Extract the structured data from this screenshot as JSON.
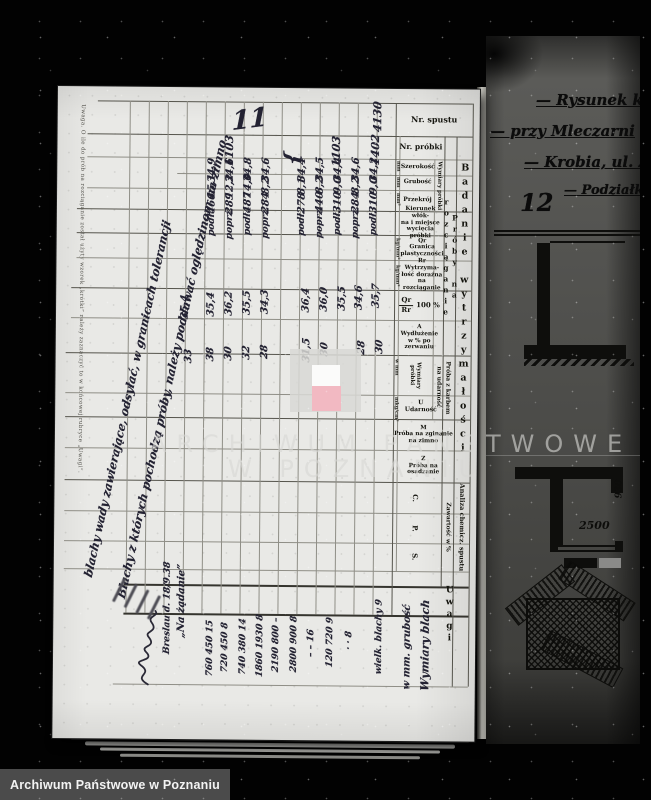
{
  "scan": {
    "watermark": {
      "line1": "ARCHIWUM PAŃSTWOWE",
      "line2": "W POZNANIU",
      "logo_gray": "#d8d8d5",
      "logo_white": "#fbfbfa",
      "logo_red": "#f2b9c2"
    },
    "footer": {
      "label": "Archiwum Państwowe w Poznaniu",
      "bg": "#4b4b4b"
    }
  },
  "ledger": {
    "page_number": "11",
    "margin_note": "Uwaga.  O ile do prób na rozciąganie został użyty wzorek „krótki” należy zaznaczyć to w końcowej rubryce „Uwagi”.",
    "headers": {
      "nr_spustu": "Nr. spustu",
      "nr_probki": "Nr. próbki",
      "szerokosc": "Szerokość",
      "grubosc": "Grubość",
      "przekroj": "Przekrój",
      "unit_mm": "mm",
      "unit_mm2": "mm²",
      "unit_kg": "kg/mm²",
      "unit_mkg": "mkg/cm²",
      "unit_wmm": "w mm",
      "wymiary_probki": "Wymiary próbki",
      "kierunek": "Kierunek włók-\nna i miejsce\nwycięcia próbki",
      "qr": "Qr\nGranica\nplastyczności",
      "rr": "Rr\nWytrzyma-\nłość doraźna\nna\nrozciąganie",
      "qr_rr_num": "Qr",
      "qr_rr_den": "Rr",
      "qr_rr_pct": "100 %",
      "a": "A\nWydłużenie\nw % po zerwaniu",
      "proba_karbem": "Próba z karbem\nna udarność",
      "u": "U\nUdarność",
      "m": "M\nPróba na zginanie\nna zimno",
      "z": "Z\nPróba na\nosadzanie",
      "proby_rozciaganie": "Próby na rozciąganie",
      "badanie": "Badanie wytrzymałości",
      "analiza": "Analiza chemicz. spustu",
      "zawartosc": "Zawartość w %",
      "c": "C.",
      "p": "P.",
      "s": "S.",
      "uwagi": "Uwagi"
    },
    "handwriting": [
      {
        "text": "11",
        "x": 192,
        "y": 32,
        "rot": -8,
        "size": 26
      },
      {
        "text": "4130",
        "x": 320,
        "y": 28,
        "size": 11
      },
      {
        "text": "1402",
        "x": 318,
        "y": 61,
        "size": 11
      },
      {
        "text": "1103",
        "x": 279,
        "y": 63,
        "size": 11
      },
      {
        "text": "1103",
        "x": 172,
        "y": 63,
        "size": 11
      },
      {
        "text": "{",
        "x": 234,
        "y": 70,
        "size": 20
      },
      {
        "text": "34,2",
        "x": 317,
        "y": 81
      },
      {
        "text": "34,6",
        "x": 299,
        "y": 81
      },
      {
        "text": "34,4",
        "x": 281,
        "y": 81
      },
      {
        "text": "34,5",
        "x": 263,
        "y": 81
      },
      {
        "text": "34,4",
        "x": 245,
        "y": 82
      },
      {
        "text": "34,6",
        "x": 209,
        "y": 82
      },
      {
        "text": "34,8",
        "x": 191,
        "y": 82
      },
      {
        "text": "34,6",
        "x": 173,
        "y": 83
      },
      {
        "text": "34,9",
        "x": 155,
        "y": 83
      },
      {
        "text": "9,0",
        "x": 317,
        "y": 97
      },
      {
        "text": "8,2",
        "x": 299,
        "y": 97
      },
      {
        "text": "9,0",
        "x": 281,
        "y": 97
      },
      {
        "text": "8,2",
        "x": 263,
        "y": 97
      },
      {
        "text": "8,1",
        "x": 245,
        "y": 98
      },
      {
        "text": "8,2",
        "x": 209,
        "y": 98
      },
      {
        "text": "14,0",
        "x": 191,
        "y": 98
      },
      {
        "text": "12,2",
        "x": 173,
        "y": 99
      },
      {
        "text": "15,1",
        "x": 155,
        "y": 99
      },
      {
        "text": "310",
        "x": 317,
        "y": 114
      },
      {
        "text": "284",
        "x": 299,
        "y": 114
      },
      {
        "text": "310",
        "x": 281,
        "y": 114
      },
      {
        "text": "440",
        "x": 263,
        "y": 114
      },
      {
        "text": "278",
        "x": 245,
        "y": 115
      },
      {
        "text": "284",
        "x": 209,
        "y": 115
      },
      {
        "text": "487",
        "x": 191,
        "y": 115
      },
      {
        "text": "289",
        "x": 173,
        "y": 116
      },
      {
        "text": "466",
        "x": 155,
        "y": 116
      },
      {
        "text": "podł.",
        "x": 317,
        "y": 134,
        "size": 9
      },
      {
        "text": "poprz.",
        "x": 299,
        "y": 134,
        "size": 9
      },
      {
        "text": "podł.",
        "x": 281,
        "y": 134,
        "size": 9
      },
      {
        "text": "poprz.",
        "x": 263,
        "y": 134,
        "size": 9
      },
      {
        "text": "podł.",
        "x": 245,
        "y": 135,
        "size": 9
      },
      {
        "text": "poprz.",
        "x": 209,
        "y": 135,
        "size": 9
      },
      {
        "text": "podł.",
        "x": 191,
        "y": 135,
        "size": 9
      },
      {
        "text": "poprz.",
        "x": 173,
        "y": 136,
        "size": 9
      },
      {
        "text": "podł.",
        "x": 155,
        "y": 136,
        "size": 9
      },
      {
        "text": "35,7",
        "x": 320,
        "y": 207
      },
      {
        "text": "34,6",
        "x": 303,
        "y": 209
      },
      {
        "text": "35,5",
        "x": 286,
        "y": 210
      },
      {
        "text": "36,0",
        "x": 268,
        "y": 211
      },
      {
        "text": "36,4",
        "x": 250,
        "y": 212
      },
      {
        "text": "34,3",
        "x": 209,
        "y": 214
      },
      {
        "text": "35,5",
        "x": 191,
        "y": 215
      },
      {
        "text": "36,2",
        "x": 173,
        "y": 216
      },
      {
        "text": "35,4",
        "x": 155,
        "y": 217
      },
      {
        "text": "35,4",
        "x": 129,
        "y": 220
      },
      {
        "text": "30",
        "x": 324,
        "y": 258
      },
      {
        "text": "28",
        "x": 306,
        "y": 259
      },
      {
        "text": "30",
        "x": 269,
        "y": 261
      },
      {
        "text": "31,5",
        "x": 251,
        "y": 262
      },
      {
        "text": "28",
        "x": 209,
        "y": 264
      },
      {
        "text": "32",
        "x": 191,
        "y": 265
      },
      {
        "text": "30",
        "x": 173,
        "y": 266
      },
      {
        "text": "38",
        "x": 155,
        "y": 267
      },
      {
        "text": "33",
        "x": 133,
        "y": 269
      },
      {
        "text": "wielk. blachy  9",
        "x": 326,
        "y": 548,
        "size": 9
      },
      {
        "text": "·   ·   8",
        "x": 296,
        "y": 552,
        "size": 9
      },
      {
        "text": "120  720  9",
        "x": 277,
        "y": 554,
        "size": 9
      },
      {
        "text": "–  –  16",
        "x": 258,
        "y": 555,
        "size": 9
      },
      {
        "text": "2800  900  8",
        "x": 241,
        "y": 556,
        "size": 9
      },
      {
        "text": "2190  800  –",
        "x": 223,
        "y": 557,
        "size": 9
      },
      {
        "text": "1860  1930  8",
        "x": 207,
        "y": 558,
        "size": 9
      },
      {
        "text": "740  380  14",
        "x": 190,
        "y": 559,
        "size": 9
      },
      {
        "text": "720  450  8",
        "x": 172,
        "y": 560,
        "size": 9
      },
      {
        "text": "760  450  15",
        "x": 157,
        "y": 561,
        "size": 9
      },
      {
        "text": "Wymiary blach",
        "x": 372,
        "y": 556,
        "size": 11
      },
      {
        "text": "w mm. grubość",
        "x": 354,
        "y": 558,
        "size": 10
      },
      {
        "text": "„Na żądanie”",
        "x": 128,
        "y": 514,
        "size": 10
      },
      {
        "text": "Breslau d. 18/9.38",
        "x": 114,
        "y": 521,
        "size": 9
      },
      {
        "text": "Blachy z których pochodzą próby, należy poddawać oględzinom na zimno",
        "x": 116,
        "y": 282,
        "rot": -78,
        "size": 11.5
      },
      {
        "text": "blachy wady zawierające, odsyłać, w granicach tolerancji",
        "x": 72,
        "y": 312,
        "rot": -78,
        "size": 11.5
      }
    ]
  },
  "next_page": {
    "page_number": "12",
    "title_lines": [
      "— Rysunek k",
      "— przy Mleczarni",
      "— Krobia, ul. Ż",
      "— Podziałk"
    ],
    "dim_a": "2500",
    "dim_b": "930"
  }
}
